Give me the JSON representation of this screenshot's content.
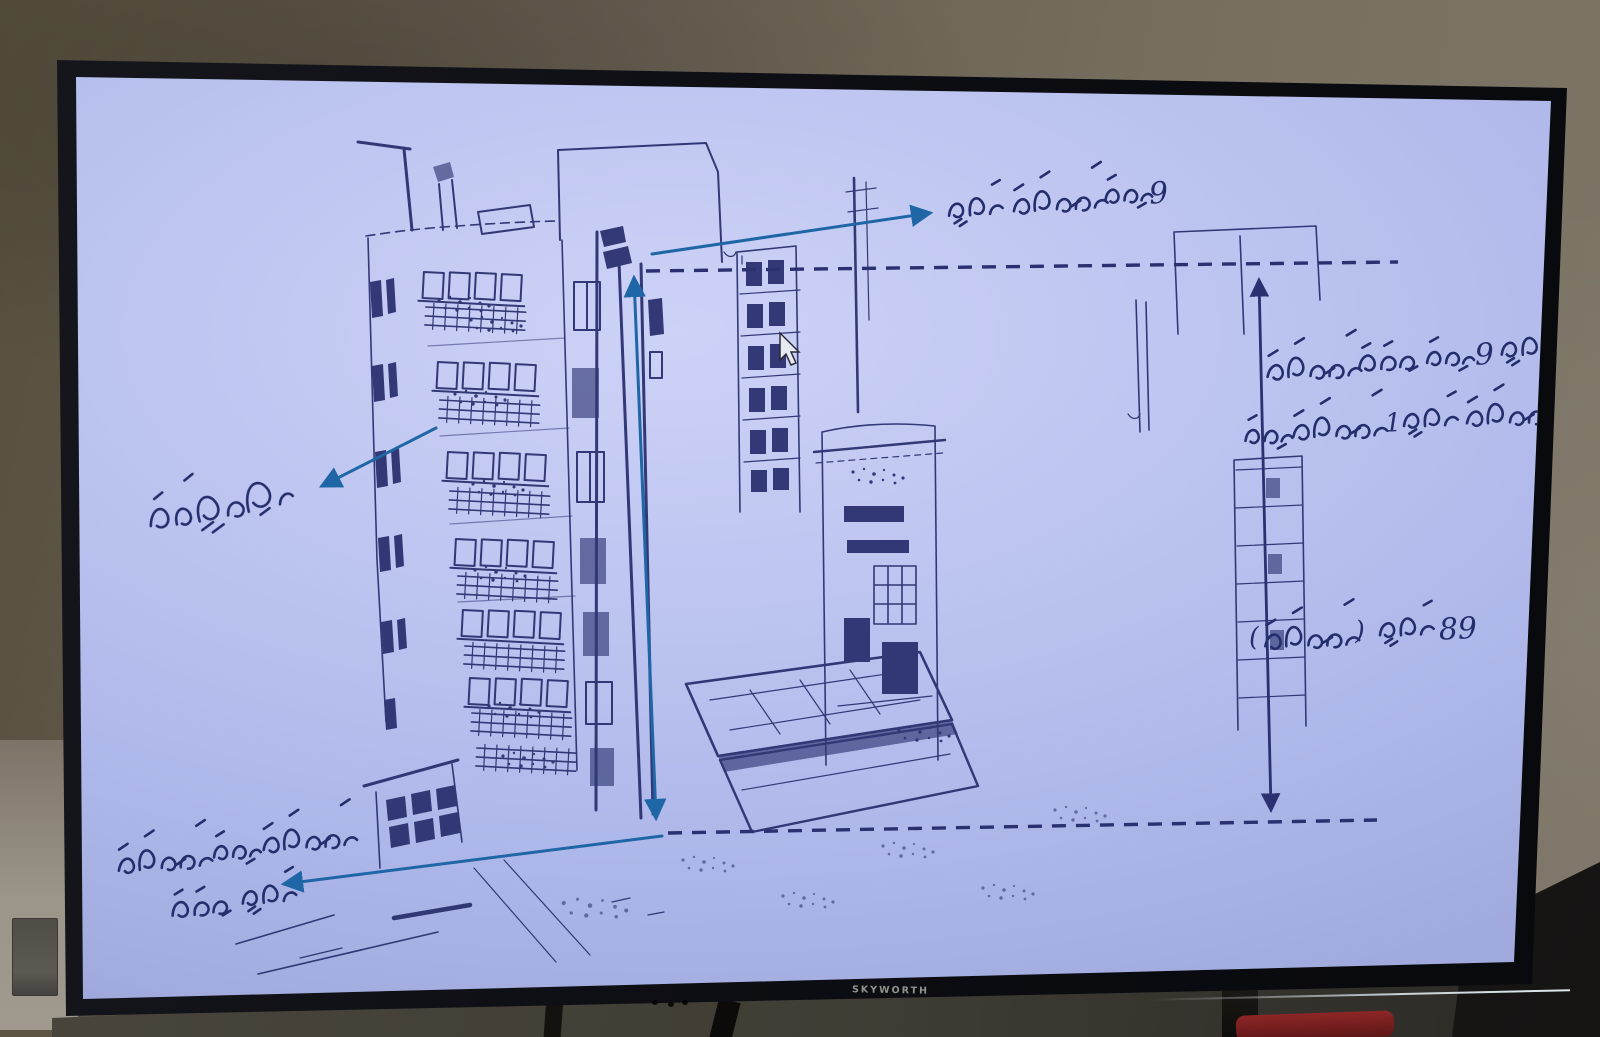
{
  "colors": {
    "screen_tint": "#b9c1ee",
    "sketch_ink": "#2b316f",
    "annotation_ink": "#242e6c",
    "callout_arrow_blue": "#1f66a6",
    "dimension_line_navy": "#2a3070",
    "tv_bezel_black": "#0c0d12",
    "wall_gray_brown": "#6e6658",
    "brand_text_gray": "#8f958f",
    "red_object": "#7c2020"
  },
  "tv": {
    "brand_label": "SKYWORTH"
  },
  "screen": {
    "drawing": {
      "annotations": {
        "top_floor_label": {
          "text": "9 ވަނަ ފްލޯގެ ފަންގިފިލާ",
          "digit": "9"
        },
        "right_note_line1": {
          "text": "ފްލޯ އެއްގެ އުސްމިނަކީ 9 ފޫޓް",
          "digit": "9"
        },
        "right_note_line2": {
          "text": "ޖުމްލަ ފްލޯއިން 1 ފޫޓް ވަށްކަށްވެފައި",
          "digit": "1"
        },
        "total_height_label": {
          "text": "89 ފޫޓް ( ވަށްކަށްވެފައި )",
          "digits": "89",
          "paren_open": "(",
          "paren_close": ")"
        },
        "balconies_label": {
          "text": "ފެންޑާތައް"
        },
        "roof_note_line1": {
          "text": "ފުރާޅުމަތީ ބަނޑިވެފައި"
        },
        "roof_note_line2": {
          "text": "އިންތަން"
        }
      }
    }
  }
}
